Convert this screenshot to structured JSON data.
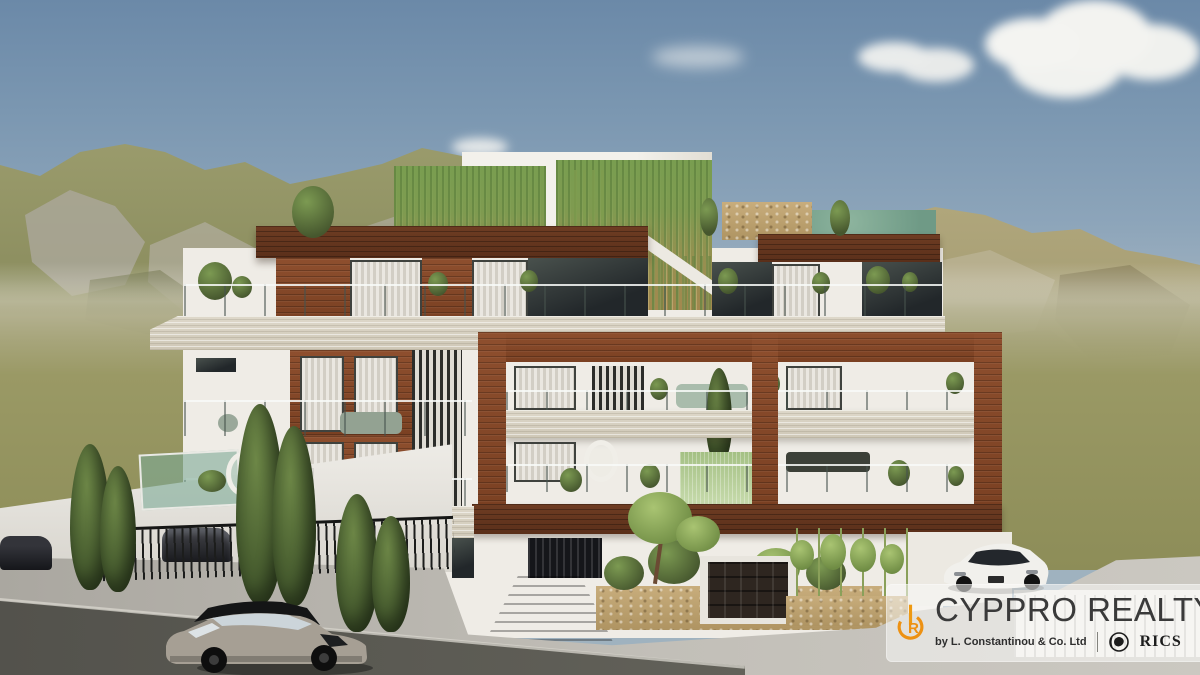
{
  "image": {
    "type": "architectural-3d-render",
    "description": "Photorealistic 3D rendering of a modern four-storey residential apartment building in white render with timber cladding, a large timber frame wing, glass-balustrade balconies, rooftop penthouses with hanging-vine green walls, landscaped gardens with cypress trees and bamboo, set against rocky green hills under a blue sky with clouds; cars on the street in the foreground."
  },
  "watermark": {
    "brand": "CYPPRO REALTY",
    "byline": "by L. Constantinou & Co. Ltd",
    "certification": "RICS",
    "monogram_letter": "R",
    "accent_color": "#ED9113",
    "text_color": "#3A3A3A",
    "band_color": "rgba(250,250,247,0.55)"
  },
  "palette": {
    "sky_top": "#6B89A8",
    "sky_horizon": "#D4D2C5",
    "cloud": "#F4F4F1",
    "hill_left_grass": "#97986A",
    "hill_rock": "#ABA89B",
    "hill_right": "#ADA374",
    "field": "#97965F",
    "building_white": "#EFECE6",
    "wood_cladding": "#8E4F2E",
    "wood_roofband": "#6F3D23",
    "stone_slab": "#DED8CA",
    "balustrade_glass": "#9FBFA8",
    "foliage": "#5F7A44",
    "asphalt": "#55544E",
    "pavement": "#B4B1A9"
  },
  "scene": {
    "sky": "blue sky with scattered white clouds",
    "hills": "rocky olive-green hills left, hazy tan hills right",
    "building": "modern apartment block with penthouse level, vine-covered screens, timber frame and balconies",
    "landscaping": "cypress trees, bamboo screens, stone planters, rooftop and balcony plants",
    "vehicles": [
      "grey SUV driving on road",
      "white sports car on driveway",
      "two dark parked cars behind side fence"
    ],
    "foreground": "dark asphalt road and light concrete pavement with driveway ramp to basement parking"
  }
}
